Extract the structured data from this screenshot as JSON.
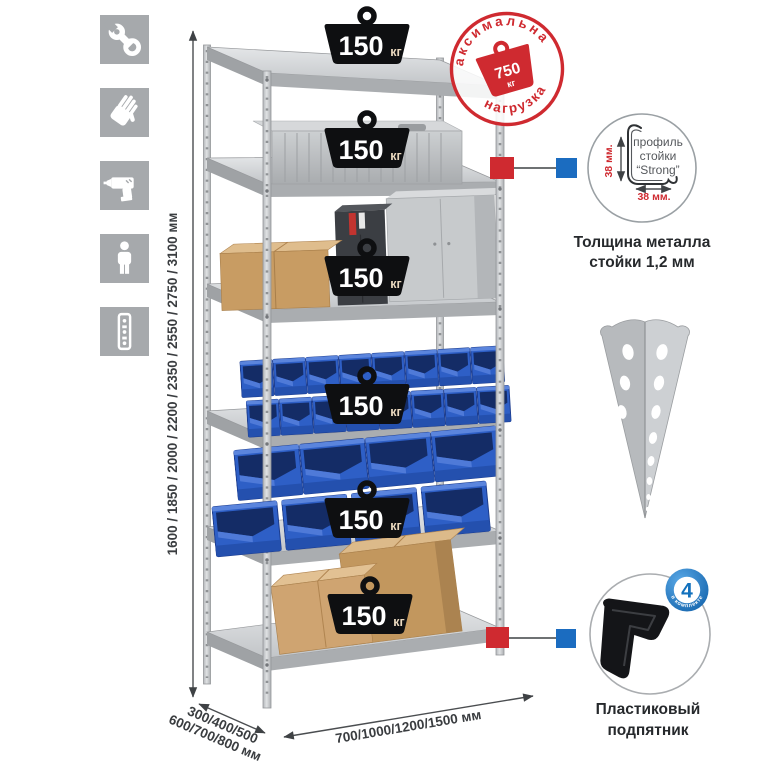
{
  "colors": {
    "accent_red": "#cf2a30",
    "accent_blue": "#1b6cc0",
    "bin_blue": "#2e5fc6",
    "icon_gray": "#a6a9ac",
    "metal_gray": "#c9ccce"
  },
  "left_icons": [
    {
      "name": "wrench-icon"
    },
    {
      "name": "gloves-icon"
    },
    {
      "name": "drill-icon"
    },
    {
      "name": "person-height-icon"
    },
    {
      "name": "upright-profile-icon"
    }
  ],
  "dimensions": {
    "height": "1600 / 1850 / 2000 / 2200 / 2350 / 2550 / 2750 / 3100 мм",
    "depth_line1": "300/400/500",
    "depth_line2": "600/700/800 мм",
    "width": "700/1000/1200/1500 мм"
  },
  "max_load_stamp": {
    "arc_top": "максимальная",
    "arc_bottom": "нагрузка",
    "value": "750",
    "unit": "кг"
  },
  "rack": {
    "shelves": [
      {
        "load": "150",
        "unit": "кг"
      },
      {
        "load": "150",
        "unit": "кг"
      },
      {
        "load": "150",
        "unit": "кг"
      },
      {
        "load": "150",
        "unit": "кг"
      },
      {
        "load": "150",
        "unit": "кг"
      },
      {
        "load": "150",
        "unit": "кг"
      }
    ]
  },
  "profile_detail": {
    "label_line1": "профиль",
    "label_line2": "стойки",
    "label_line3": "“Strong”",
    "dim_vertical": "38 мм.",
    "dim_horizontal": "38 мм.",
    "caption_line1": "Толщина металла",
    "caption_line2": "стойки 1,2 мм"
  },
  "foot_detail": {
    "count": "4",
    "ring_text": "в комплекте",
    "caption_line1": "Пластиковый",
    "caption_line2": "подпятник"
  }
}
